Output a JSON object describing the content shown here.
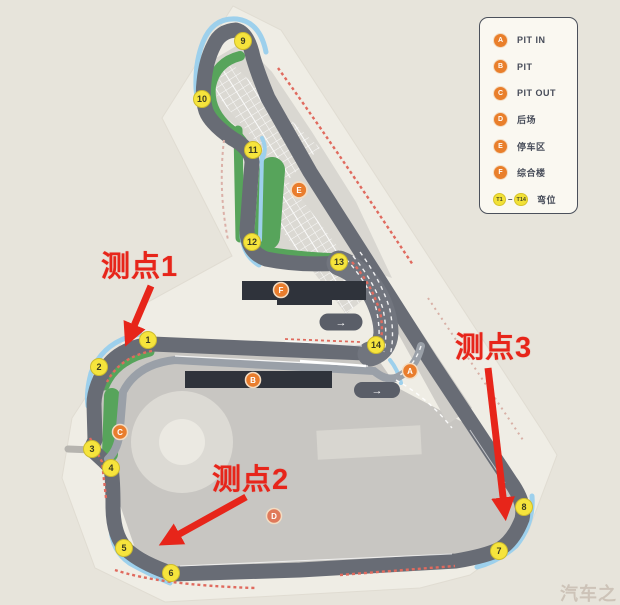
{
  "legend": {
    "items": [
      {
        "letter": "A",
        "label": "PIT IN"
      },
      {
        "letter": "B",
        "label": "PIT"
      },
      {
        "letter": "C",
        "label": "PIT OUT"
      },
      {
        "letter": "D",
        "label": "后场"
      },
      {
        "letter": "E",
        "label": "停车区"
      },
      {
        "letter": "F",
        "label": "综合楼"
      }
    ],
    "turn_range": {
      "from": "T1",
      "dash": "–",
      "to": "T14",
      "label": "弯位"
    }
  },
  "annotations": {
    "point1": "测点1",
    "point2": "测点2",
    "point3": "测点3"
  },
  "track": {
    "turn_labels": [
      "1",
      "2",
      "3",
      "4",
      "5",
      "6",
      "7",
      "8",
      "9",
      "10",
      "11",
      "12",
      "13",
      "14"
    ],
    "facility_labels": [
      "A",
      "B",
      "C",
      "D",
      "E",
      "F"
    ],
    "direction_arrow_glyph": "→"
  },
  "watermark": {
    "text": "汽车之家"
  },
  "colors": {
    "background": "#e7e4db",
    "parcel": "#efede5",
    "asphalt": "#686c75",
    "infield_green": "#57a45b",
    "curb_blue": "#9dd0ec",
    "curb_red": "#e06a5e",
    "marker_yellow": "#f6e43c",
    "marker_orange": "#e97d2d",
    "annotation_red": "#e7251a"
  }
}
